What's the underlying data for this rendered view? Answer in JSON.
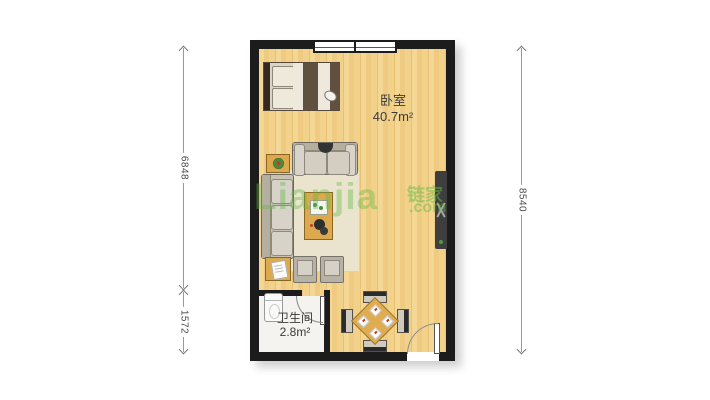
{
  "rooms": [
    {
      "name": "卧室",
      "area": "40.7m²"
    },
    {
      "name": "卫生间",
      "area": "2.8m²"
    }
  ],
  "dimensions": {
    "left_upper": "6848",
    "left_lower": "1572",
    "right": "8540"
  },
  "watermark": {
    "brand_latin": "Lianjia",
    "brand_cn": "链家",
    "suffix": ".com"
  },
  "colors": {
    "wall": "#1c1c1c",
    "floor_wood": "#f2d28b",
    "bathroom_floor": "#f4f3ef",
    "rug": "#eae4cf",
    "furniture_wood": "#dca94f",
    "watermark_green": "#61ba44"
  },
  "icons": [
    "bed-icon",
    "sofa-icon",
    "loveseat-icon",
    "coffee-table-icon",
    "side-table-plant-icon",
    "side-table-book-icon",
    "ottoman-icon",
    "tv-icon",
    "toilet-icon",
    "dining-table-icon",
    "dining-chair-icon",
    "window-icon",
    "door-icon",
    "rug-icon"
  ]
}
